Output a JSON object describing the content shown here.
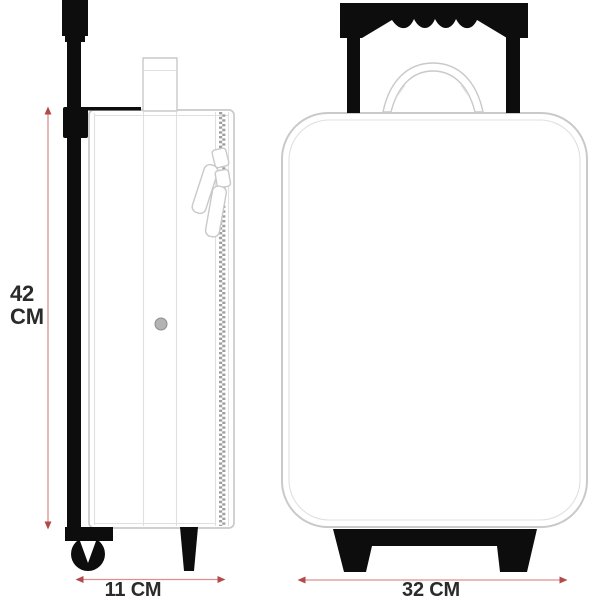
{
  "diagram": {
    "dimensions": {
      "height": {
        "value": "42",
        "unit": "CM",
        "label": "42 CM"
      },
      "depth": {
        "value": "11",
        "unit": "CM",
        "label": "11 CM"
      },
      "width": {
        "value": "32",
        "unit": "CM",
        "label": "32 CM"
      }
    },
    "colors": {
      "background": "#ffffff",
      "black": "#0d0d0d",
      "outline": "#c9c9c9",
      "outline_light": "#e0e0e0",
      "dimension_line": "#dd8f8f",
      "dimension_arrow": "#b24a4a",
      "text": "#2b2b2b"
    }
  }
}
